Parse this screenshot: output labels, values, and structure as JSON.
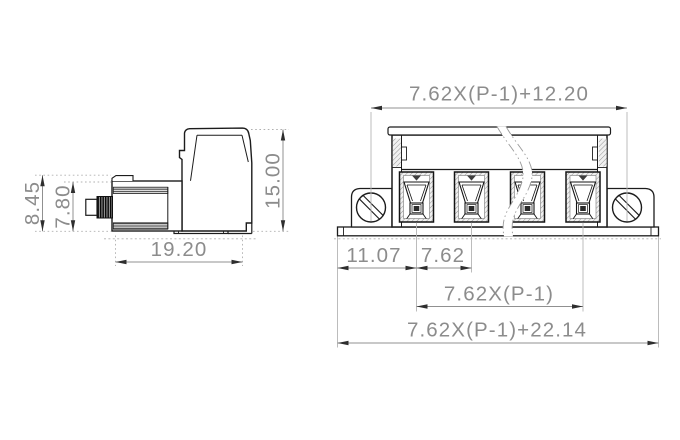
{
  "page": {
    "background": "#ffffff"
  },
  "drawing": {
    "kind": "terminal-block-connector-dimension-drawing",
    "colors": {
      "outline": "#1c1c1c",
      "dimension_line": "#909090",
      "dimension_text": "#8c8c8c"
    },
    "side_view": {
      "dims": {
        "height_outer": "8.45",
        "height_inner": "7.80",
        "body_width": "19.20",
        "overall_height": "15.00"
      }
    },
    "front_view": {
      "poles_shown": 4,
      "dims": {
        "top_span": "7.62X(P-1)+12.20",
        "end_offset": "11.07",
        "pitch": "7.62",
        "pole_span": "7.62X(P-1)",
        "overall_width": "7.62X(P-1)+22.14"
      }
    }
  }
}
